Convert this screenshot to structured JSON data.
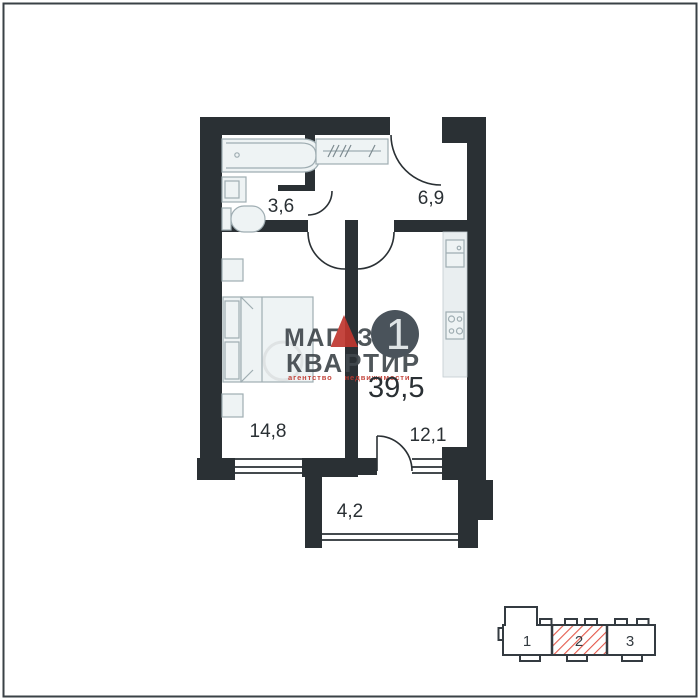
{
  "page": {
    "background": "#ffffff",
    "frame_color": "#3a4146"
  },
  "floor_plan": {
    "wall_color": "#2a3034",
    "fixture_fill": "#eef3f4",
    "fixture_stroke": "#9fadb2",
    "rooms": [
      {
        "name": "bathroom",
        "area_label": "3,6"
      },
      {
        "name": "hallway",
        "area_label": "6,9"
      },
      {
        "name": "living-room",
        "area_label": "14,8"
      },
      {
        "name": "kitchen",
        "area_label": "12,1"
      },
      {
        "name": "balcony",
        "area_label": "4,2"
      }
    ],
    "total_area_label": "39,5",
    "room_count_badge": "1",
    "badge_color": "#4a535b"
  },
  "watermark": {
    "brand_line1_left": "МАГ",
    "brand_line1_right": "ЗИН",
    "brand_line2": "КВАРТИР",
    "tagline": "агентство недвижимости",
    "text_color": "#41484d",
    "accent_color": "#c0372f"
  },
  "site_plan": {
    "outline_color": "#343b41",
    "hatch_color": "#e4584a",
    "sections": [
      {
        "label": "1",
        "highlighted": false
      },
      {
        "label": "2",
        "highlighted": true
      },
      {
        "label": "3",
        "highlighted": false
      }
    ]
  }
}
